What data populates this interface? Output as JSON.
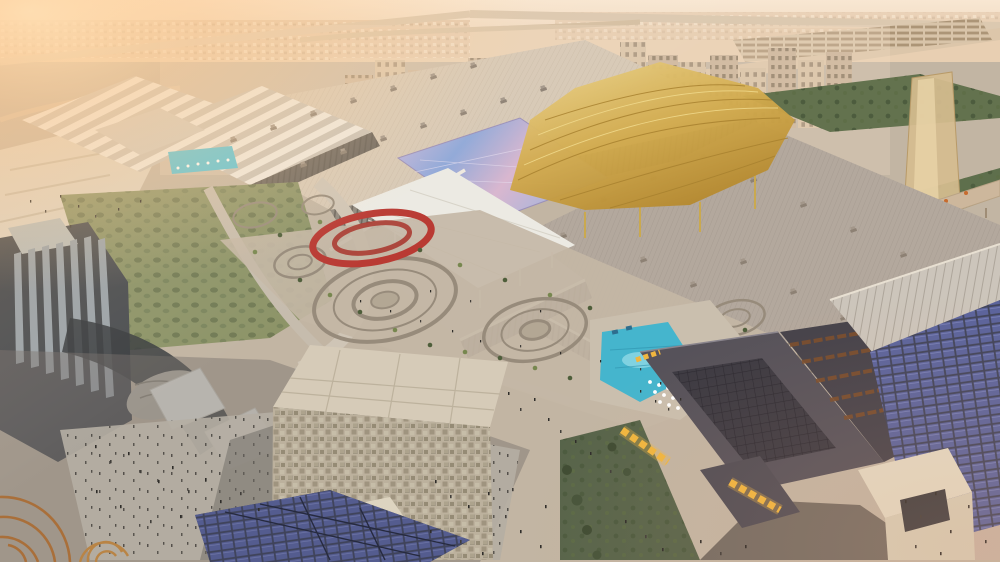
{
  "meta": {
    "type": "aerial-architectural-rendering",
    "description": "Sunrise aerial rendering of a vast exhibition-centre complex: long ribbed convention-hall roofs, a flowing golden entrance canopy, an iridescent purple-blue roof, circular landscaped gardens with palm trees, a turquoise leisure pool with umbrellas, a cubic mosaic-faced building, dark food halls with yellow-lit container stalls, rooftop solar arrays, crowds of tiny pedestrians on plazas, and a dense beige city skyline with highways on the hazy horizon."
  },
  "scene": {
    "elements": [
      {
        "name": "sky-haze",
        "label": "warm hazy sky with sun glow at top left"
      },
      {
        "name": "city-skyline",
        "label": "dense beige mid-rise city blocks on horizon"
      },
      {
        "name": "highways",
        "label": "desert highways and interchange along the top"
      },
      {
        "name": "exhibition-halls",
        "label": "large ribbed exhibition hall roofs with vents"
      },
      {
        "name": "golden-canopy",
        "label": "flowing golden lattice entrance canopy"
      },
      {
        "name": "iridescent-roof",
        "label": "iridescent purple-blue shimmering roof"
      },
      {
        "name": "white-concourse-canopy",
        "label": "white angular concourse canopy on thin columns"
      },
      {
        "name": "circular-gardens",
        "label": "concentric circular garden plazas with palms"
      },
      {
        "name": "flower-ring",
        "label": "oval ring of red flowers"
      },
      {
        "name": "leisure-pool",
        "label": "turquoise pool with white umbrellas and sun deck"
      },
      {
        "name": "cube-building",
        "label": "cubic building with mosaic stone facade"
      },
      {
        "name": "food-hall",
        "label": "dark market halls with yellow-lit container stalls"
      },
      {
        "name": "solar-roof",
        "label": "rooftop photovoltaic panel array"
      },
      {
        "name": "fortress-building",
        "label": "dark finned building with curved terrace"
      },
      {
        "name": "tent-canopies",
        "label": "white tent canopy roofs"
      },
      {
        "name": "basket-pavilion",
        "label": "woven rattan pavilion ribs in corner"
      },
      {
        "name": "glass-tower",
        "label": "tall translucent glass tower at right"
      },
      {
        "name": "green-park",
        "label": "green park strips with orange flowering trees"
      },
      {
        "name": "pedestrians",
        "label": "scattered tiny pedestrians on walkways"
      }
    ]
  },
  "colors": {
    "sky_top": "#f6e3cd",
    "sky_low": "#e6cbae",
    "sun_glow": "#ffd9a4",
    "ground": "#c2b5a3",
    "far_desert": "#e8cfb2",
    "city_base": "#c7b197",
    "hall_roof_main": "#d7c9b6",
    "hall_roof_right": "#b3a89d",
    "hall_roof_front": "#bcb2a8",
    "sawtooth_light": "#eee9e0",
    "sawtooth_dark": "#ccc5ba",
    "facade_dark": "#8d857b",
    "gold_canopy": "#d2ab4e",
    "iridescent_violet": "#c9b6e0",
    "iridescent_blue": "#8fa8d8",
    "white_canopy": "#eceae3",
    "lawn_green": "#8d9468",
    "garden_ground": "#c4b7a5",
    "garden_ring": "#978b7b",
    "flower_red": "#b93a33",
    "palm_green": "#4e5e3a",
    "pool_teal": "#45b5cd",
    "cube_facade": "#c3b8a3",
    "cube_roof": "#d6cbb8",
    "foodhall_dark": "#56525a",
    "stall_yellow": "#f0b63f",
    "container_rust": "#7a4e2c",
    "solar_blue": "#5a639c",
    "cream_building": "#e3dac4",
    "fortress_gray": "#4b4e51",
    "glass_tower_gold": "#d6bd8f",
    "road_light": "#cfc5b6",
    "pavement_shadow": "#77726c",
    "people_dark": "#2f2d2a",
    "basket_brown": "#a96f3a"
  }
}
